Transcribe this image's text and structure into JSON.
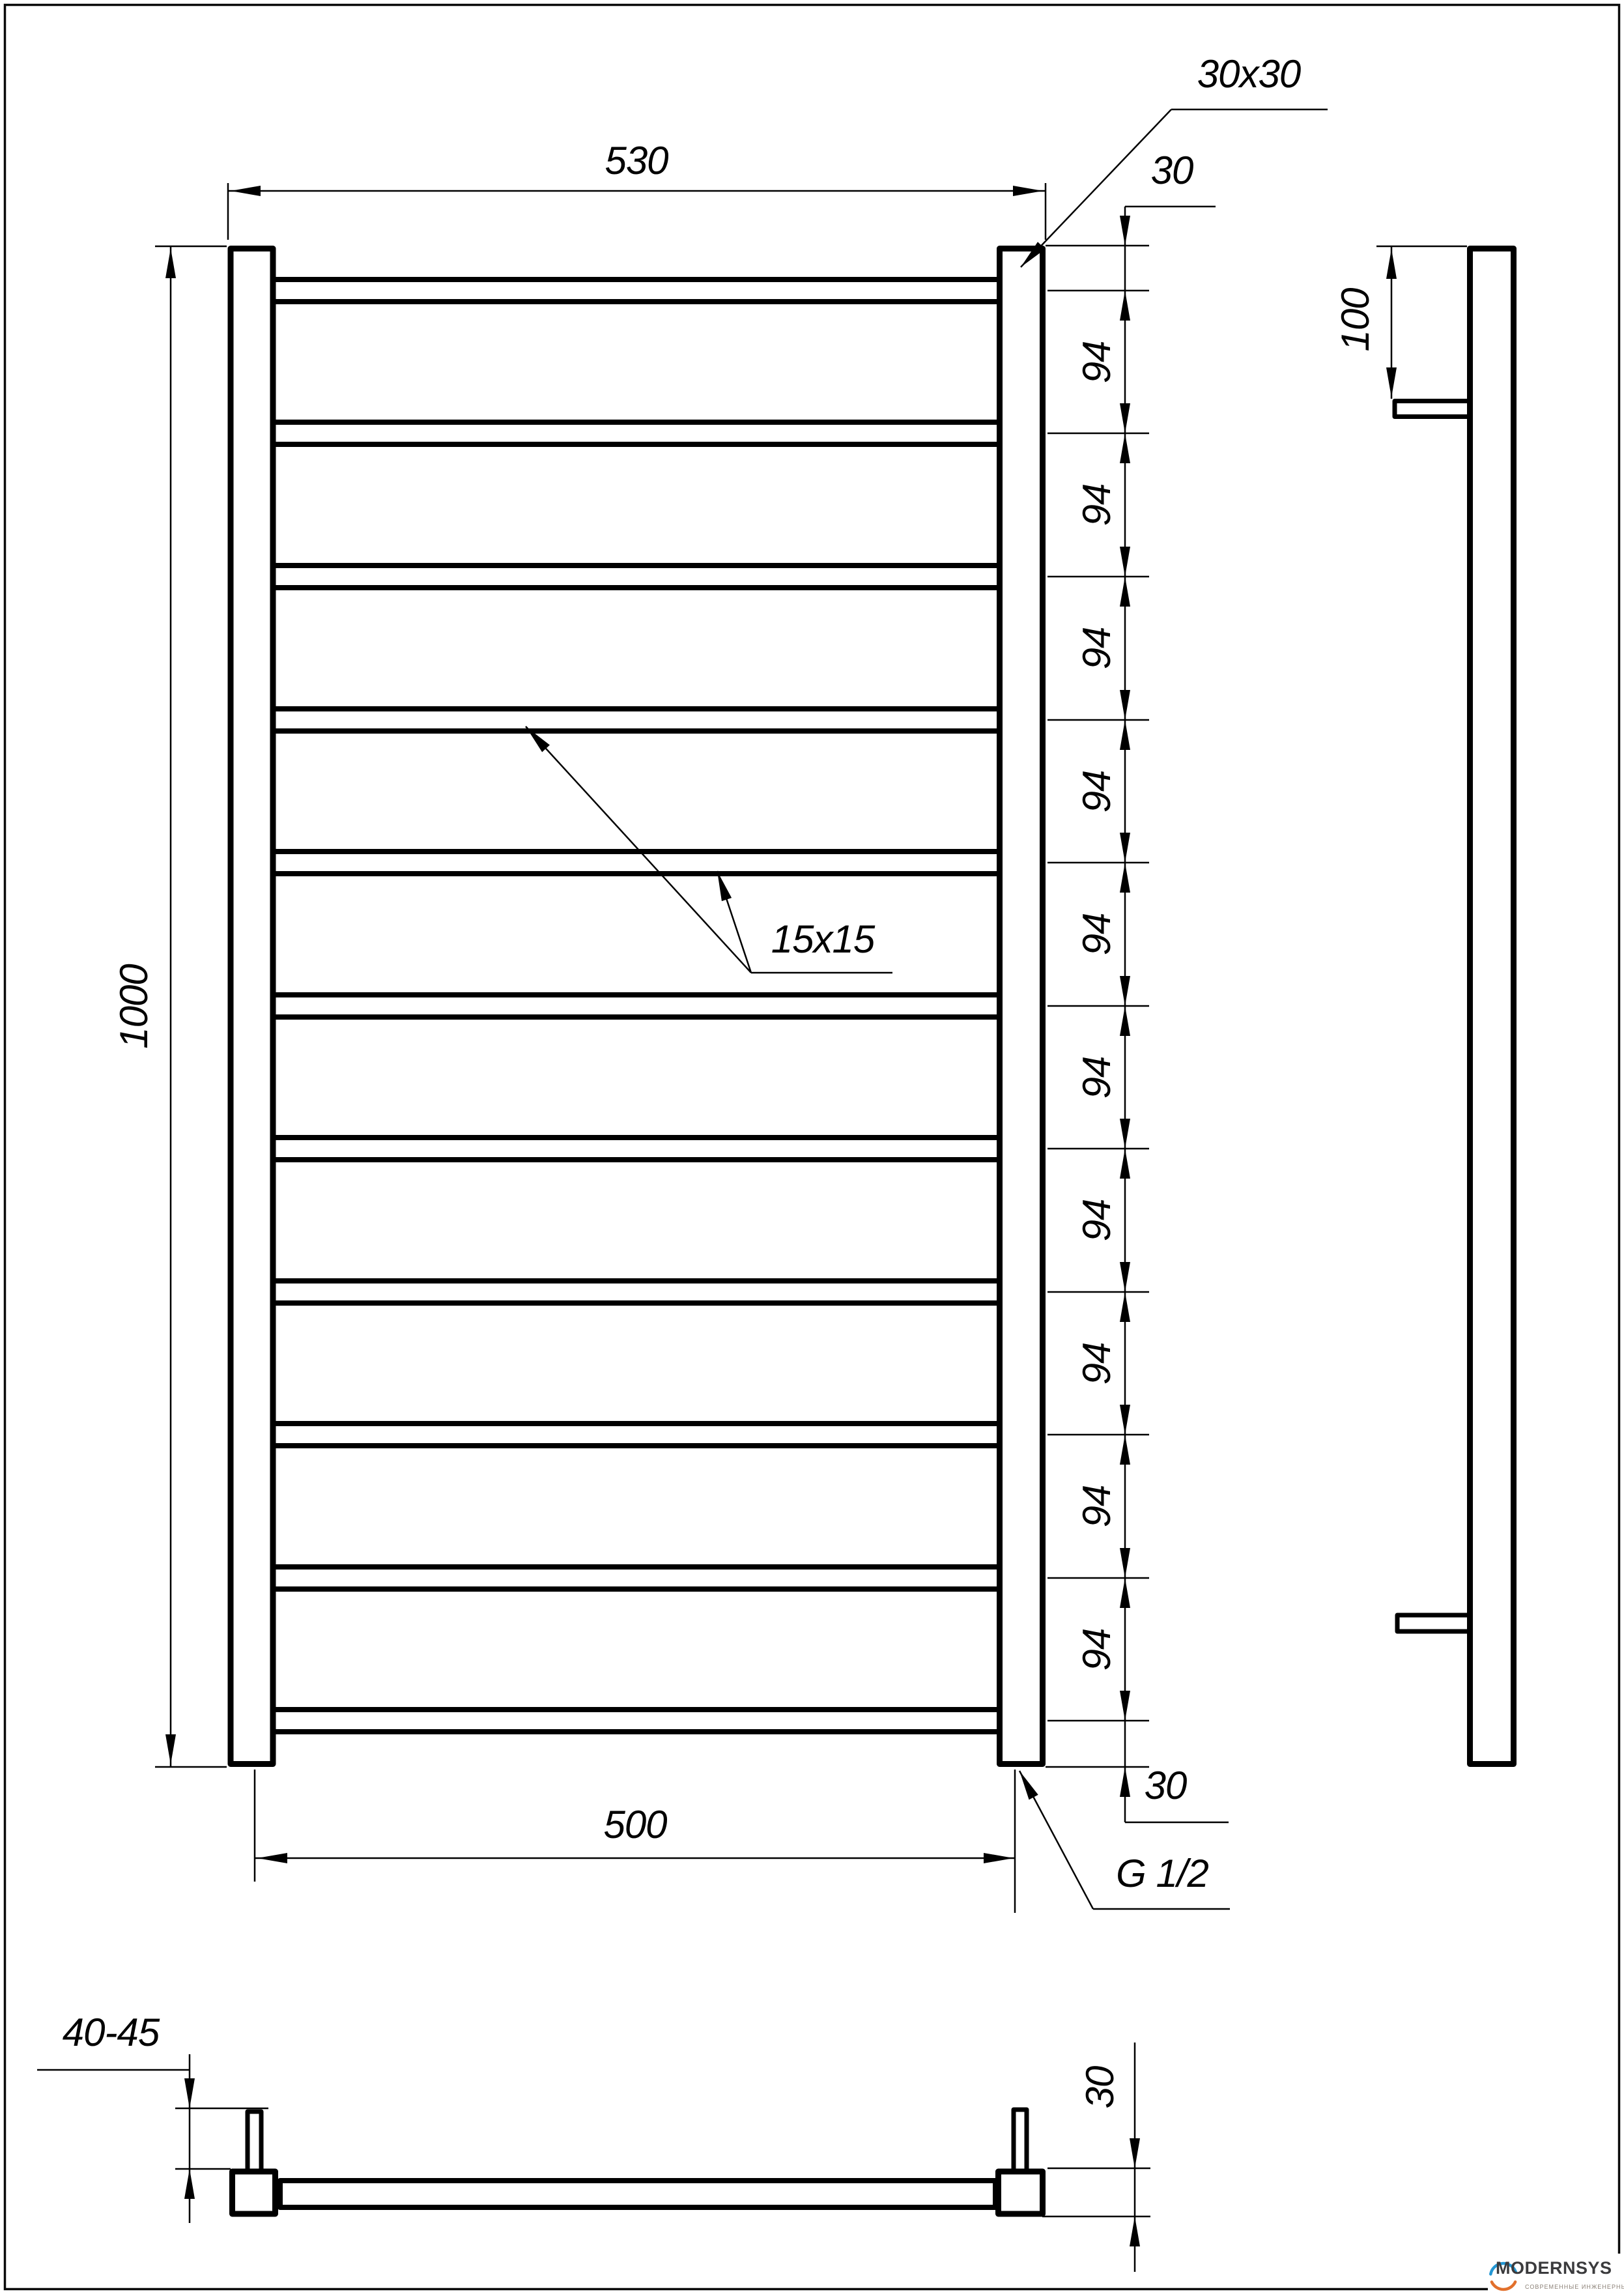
{
  "page": {
    "background": "#ffffff",
    "line_color": "#000000"
  },
  "dimensions": {
    "top_width": "530",
    "bottom_width": "500",
    "height": "1000",
    "post_section": "30x30",
    "top_offset": "30",
    "rung_spacing": "94",
    "bottom_offset": "30",
    "rung_section": "15x15",
    "thread": "G 1/2",
    "side_bracket_offset": "100",
    "wall_clearance": "40-45",
    "bottom_view_depth": "30"
  },
  "logo": {
    "name": "MODERNSYS",
    "tagline": "СОВРЕМЕННЫЕ ИНЖЕНЕРНЫЕ СИСТЕМЫ",
    "blue": "#2397d4",
    "orange": "#e2702c",
    "text_color": "#3b3b3d",
    "tagline_color": "#8b8076"
  }
}
